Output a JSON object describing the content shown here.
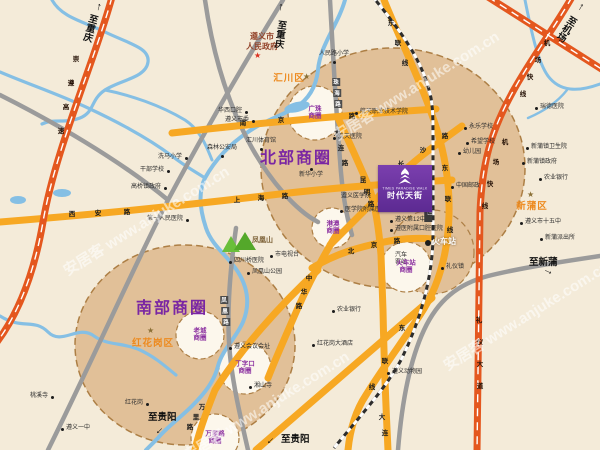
{
  "map": {
    "watermark_text": "安居客 www.anjuke.com.cn",
    "watermarks": [
      {
        "x": 50,
        "y": 210
      },
      {
        "x": 320,
        "y": 75
      },
      {
        "x": 170,
        "y": 395
      },
      {
        "x": 430,
        "y": 305
      }
    ],
    "government": {
      "name": "遵义市人民政府",
      "display": "遵义市\n人民政府",
      "x": 262,
      "y": 32,
      "star_x": 254,
      "star_y": 52
    },
    "district_labels": [
      {
        "name": "汇川区",
        "x": 289,
        "y": 77,
        "star_x": 303,
        "star_y": 73
      },
      {
        "name": "新蒲区",
        "x": 532,
        "y": 205,
        "star_x": 527,
        "star_y": 191
      },
      {
        "name": "红花岗区",
        "x": 153,
        "y": 342,
        "star_x": 147,
        "star_y": 327
      }
    ],
    "major_circle_labels": [
      {
        "name": "北部商圈",
        "x": 296,
        "y": 156
      },
      {
        "name": "南部商圈",
        "x": 172,
        "y": 306
      }
    ],
    "sub_circle_labels": [
      {
        "name": "广珠商圈",
        "display": "广珠\n商圈",
        "x": 315,
        "y": 113
      },
      {
        "name": "港澳商圈",
        "display": "港澳\n商圈",
        "x": 333,
        "y": 228
      },
      {
        "name": "老城商圈",
        "display": "老城\n商圈",
        "x": 200,
        "y": 335
      },
      {
        "name": "丁字口商圈",
        "display": "丁字口\n商圈",
        "x": 245,
        "y": 368
      },
      {
        "name": "万里路商圈",
        "display": "万里路\n商圈",
        "x": 215,
        "y": 438
      },
      {
        "name": "火车站商圈",
        "display": "火车站\n商圈",
        "x": 406,
        "y": 267
      }
    ],
    "landmark": {
      "name_cn": "时代天街",
      "name_en": "TIMES PARADISE WALK"
    },
    "railway_label": {
      "text": "黔渝铁路（在建）",
      "x": 428,
      "y": 166
    },
    "mountain_label": {
      "text": "凤凰山",
      "x": 252,
      "y": 235
    },
    "directions": [
      {
        "text": "至重庆",
        "vert": true,
        "x": 86,
        "y": 14,
        "rot": 16,
        "ax": 96,
        "ay": 2,
        "arot": 14
      },
      {
        "text": "至重庆",
        "vert": true,
        "x": 274,
        "y": 20,
        "rot": 8,
        "ax": 278,
        "ay": 2,
        "arot": 6
      },
      {
        "text": "至机场",
        "vert": true,
        "x": 566,
        "y": 16,
        "rot": 32,
        "ax": 578,
        "ay": 2,
        "arot": 30
      },
      {
        "text": "至新蒲",
        "vert": false,
        "x": 529,
        "y": 254,
        "rot": 0,
        "ax": 545,
        "ay": 266,
        "arot": 115
      },
      {
        "text": "至贵阳",
        "vert": false,
        "x": 148,
        "y": 409,
        "rot": 0,
        "ax": 157,
        "ay": 425,
        "arot": 225
      },
      {
        "text": "至贵阳",
        "vert": false,
        "x": 281,
        "y": 431,
        "rot": 0,
        "ax": 268,
        "ay": 435,
        "arot": 225
      }
    ],
    "road_labels": [
      {
        "name": "南京路",
        "style": "amber",
        "chars": [
          [
            243,
            122
          ],
          [
            281,
            119
          ],
          [
            352,
            115
          ]
        ]
      },
      {
        "name": "上海路",
        "style": "amber",
        "chars": [
          [
            237,
            199
          ],
          [
            261,
            197
          ],
          [
            285,
            195
          ]
        ]
      },
      {
        "name": "西安路",
        "style": "amber",
        "chars": [
          [
            72,
            213
          ],
          [
            98,
            212
          ],
          [
            127,
            211
          ]
        ]
      },
      {
        "name": "北京路",
        "style": "amber",
        "chars": [
          [
            351,
            250
          ],
          [
            374,
            244
          ],
          [
            397,
            240
          ]
        ]
      },
      {
        "name": "大连路",
        "style": "amber",
        "chars": [
          [
            337,
            132
          ],
          [
            341,
            147
          ],
          [
            345,
            162
          ]
        ]
      },
      {
        "name": "大连路",
        "text": "大连",
        "style": "amber",
        "chars": [
          [
            382,
            416
          ],
          [
            385,
            432
          ]
        ]
      },
      {
        "name": "昆明路",
        "style": "amber",
        "chars": [
          [
            363,
            179
          ],
          [
            367,
            191
          ],
          [
            371,
            203
          ]
        ]
      },
      {
        "name": "长沙路",
        "style": "amber",
        "chars": [
          [
            401,
            163
          ],
          [
            423,
            149
          ],
          [
            445,
            135
          ]
        ]
      },
      {
        "name": "东联线",
        "style": "amber",
        "chars": [
          [
            391,
            22
          ],
          [
            398,
            42
          ],
          [
            405,
            62
          ]
        ]
      },
      {
        "name": "东联线",
        "style": "amber",
        "chars": [
          [
            445,
            167
          ],
          [
            448,
            198
          ],
          [
            450,
            229
          ]
        ]
      },
      {
        "name": "东联线",
        "style": "amber",
        "chars": [
          [
            402,
            327
          ],
          [
            385,
            360
          ],
          [
            372,
            386
          ]
        ]
      },
      {
        "name": "万里路",
        "style": "amber",
        "chars": [
          [
            202,
            406
          ],
          [
            196,
            416
          ],
          [
            190,
            426
          ]
        ]
      },
      {
        "name": "中华路",
        "style": "amber",
        "chars": [
          [
            309,
            277
          ],
          [
            304,
            291
          ],
          [
            299,
            305
          ]
        ]
      },
      {
        "name": "礼仪大道",
        "style": "hw",
        "chars": [
          [
            479,
            319
          ],
          [
            480,
            341
          ],
          [
            480,
            363
          ],
          [
            480,
            385
          ]
        ]
      },
      {
        "name": "机场快线",
        "style": "hw",
        "chars": [
          [
            547,
            42
          ],
          [
            538,
            59
          ],
          [
            530,
            76
          ],
          [
            523,
            93
          ]
        ]
      },
      {
        "name": "机场快线",
        "style": "hw",
        "chars": [
          [
            505,
            141
          ],
          [
            496,
            161
          ],
          [
            490,
            183
          ],
          [
            485,
            205
          ]
        ]
      },
      {
        "name": "崇遵高速",
        "style": "hw",
        "chars": [
          [
            76,
            58
          ],
          [
            71,
            82
          ],
          [
            66,
            106
          ],
          [
            61,
            130
          ]
        ]
      },
      {
        "name": "凤凰路",
        "style": "gray",
        "chars": [
          [
            224,
            300
          ],
          [
            225,
            311
          ],
          [
            226,
            322
          ]
        ]
      },
      {
        "name": "珠海路",
        "style": "gray",
        "chars": [
          [
            336,
            82
          ],
          [
            337,
            93
          ],
          [
            338,
            104
          ]
        ]
      }
    ],
    "pois": [
      {
        "name": "第一人民医院",
        "x": 187,
        "y": 220,
        "side": "l"
      },
      {
        "name": "华西口腔",
        "x": 246,
        "y": 112,
        "side": "l"
      },
      {
        "name": "遵义市委",
        "x": 253,
        "y": 121,
        "side": "l"
      },
      {
        "name": "汇川体育馆",
        "x": 261,
        "y": 149,
        "side": "t"
      },
      {
        "name": "森林公安局",
        "x": 222,
        "y": 156,
        "side": "t"
      },
      {
        "name": "洗马小学",
        "x": 186,
        "y": 158,
        "side": "l"
      },
      {
        "name": "干部学校",
        "x": 168,
        "y": 171,
        "side": "l"
      },
      {
        "name": "高桥镇政府",
        "x": 165,
        "y": 188,
        "side": "l"
      },
      {
        "name": "人民路小学",
        "x": 334,
        "y": 62,
        "side": "t"
      },
      {
        "name": "航天职业技术学院",
        "x": 356,
        "y": 113,
        "side": "r"
      },
      {
        "name": "航天医院",
        "x": 334,
        "y": 138,
        "side": "r"
      },
      {
        "name": "新华小学",
        "x": 311,
        "y": 169,
        "side": "b"
      },
      {
        "name": "遵义医学院",
        "x": 356,
        "y": 197,
        "side": "c",
        "dot": false
      },
      {
        "name": "医学院附属医院",
        "x": 341,
        "y": 211,
        "side": "r"
      },
      {
        "name": "遵义第12中学",
        "x": 391,
        "y": 221,
        "side": "r"
      },
      {
        "name": "遵医附属口腔医院",
        "x": 391,
        "y": 230,
        "side": "r"
      },
      {
        "name": "汽车客站",
        "display": "汽车\n客站",
        "x": 401,
        "y": 259,
        "side": "c",
        "dot": false
      },
      {
        "name": "火车站",
        "x": 428,
        "y": 243,
        "side": "r",
        "type": "station"
      },
      {
        "name": "礼仪镇",
        "x": 442,
        "y": 268,
        "side": "r"
      },
      {
        "name": "中国邮政",
        "x": 452,
        "y": 187,
        "side": "r"
      },
      {
        "name": "永乐学校",
        "x": 465,
        "y": 128,
        "side": "r"
      },
      {
        "name": "希望学校",
        "x": 467,
        "y": 143,
        "side": "r"
      },
      {
        "name": "幼儿园",
        "x": 459,
        "y": 153,
        "side": "r"
      },
      {
        "name": "瑞德医院",
        "x": 536,
        "y": 108,
        "side": "r"
      },
      {
        "name": "新蒲镇卫生院",
        "x": 527,
        "y": 148,
        "side": "r"
      },
      {
        "name": "新蒲镇政府",
        "x": 523,
        "y": 163,
        "side": "r"
      },
      {
        "name": "农业银行",
        "x": 540,
        "y": 179,
        "side": "r"
      },
      {
        "name": "遵义市十五中",
        "x": 521,
        "y": 223,
        "side": "r"
      },
      {
        "name": "新蒲派出所",
        "x": 541,
        "y": 239,
        "side": "r"
      },
      {
        "name": "农业银行",
        "x": 333,
        "y": 311,
        "side": "r"
      },
      {
        "name": "红花岗大酒店",
        "x": 313,
        "y": 345,
        "side": "r"
      },
      {
        "name": "遵义动物园",
        "x": 388,
        "y": 373,
        "side": "r"
      },
      {
        "name": "遵义会议会址",
        "x": 230,
        "y": 348,
        "side": "r"
      },
      {
        "name": "湘山寺",
        "x": 250,
        "y": 387,
        "side": "r"
      },
      {
        "name": "凤凰山公园",
        "x": 248,
        "y": 273,
        "side": "r"
      },
      {
        "name": "四川桥医院",
        "x": 230,
        "y": 262,
        "side": "r"
      },
      {
        "name": "市电视台",
        "x": 271,
        "y": 256,
        "side": "r"
      },
      {
        "name": "桃溪寺",
        "x": 52,
        "y": 397,
        "side": "l"
      },
      {
        "name": "遵义一中",
        "x": 62,
        "y": 429,
        "side": "r"
      },
      {
        "name": "红花岗",
        "x": 147,
        "y": 404,
        "side": "l"
      }
    ]
  }
}
